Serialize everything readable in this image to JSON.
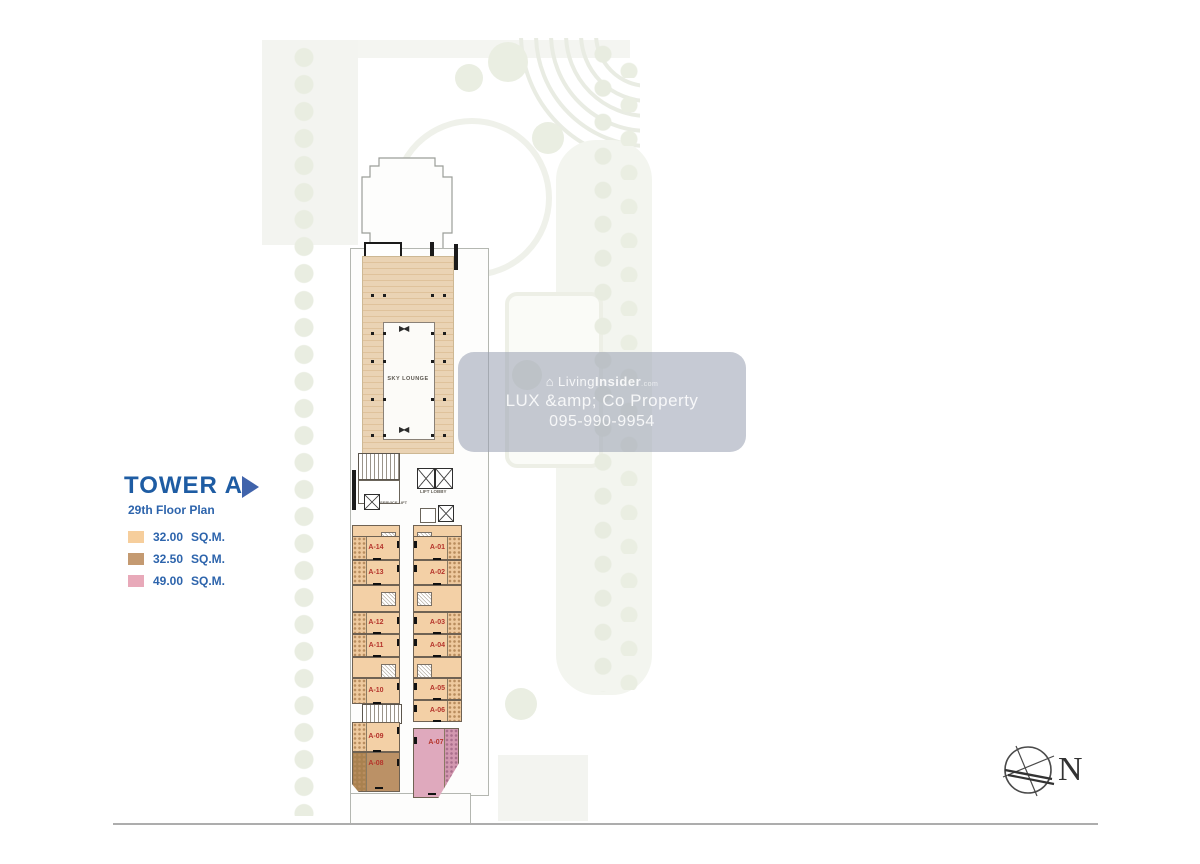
{
  "legend": {
    "title": "TOWER A",
    "subtitle": "29th Floor Plan",
    "entries": [
      {
        "color": "#F6CE9C",
        "area": "32.00",
        "unit": "SQ.M."
      },
      {
        "color": "#C49A71",
        "area": "32.50",
        "unit": "SQ.M."
      },
      {
        "color": "#E8A9B9",
        "area": "49.00",
        "unit": "SQ.M."
      }
    ]
  },
  "plan": {
    "labels": {
      "sky_lounge": "SKY LOUNGE",
      "lift_lobby": "LIFT LOBBY",
      "service_lift": "SERVICE LIFT"
    },
    "units": [
      {
        "label": "A-01",
        "size_sqm": "32.00"
      },
      {
        "label": "A-02",
        "size_sqm": "32.00"
      },
      {
        "label": "A-03",
        "size_sqm": "32.00"
      },
      {
        "label": "A-04",
        "size_sqm": "32.00"
      },
      {
        "label": "A-05",
        "size_sqm": "32.00"
      },
      {
        "label": "A-06",
        "size_sqm": "32.00"
      },
      {
        "label": "A-07",
        "size_sqm": "49.00"
      },
      {
        "label": "A-08",
        "size_sqm": "32.50"
      },
      {
        "label": "A-09",
        "size_sqm": "32.00"
      },
      {
        "label": "A-10",
        "size_sqm": "32.00"
      },
      {
        "label": "A-11",
        "size_sqm": "32.00"
      },
      {
        "label": "A-12",
        "size_sqm": "32.00"
      },
      {
        "label": "A-13",
        "size_sqm": "32.00"
      },
      {
        "label": "A-14",
        "size_sqm": "32.00"
      }
    ],
    "colors": {
      "unit_32": "#F3D0A6",
      "unit_325": "#BB9166",
      "unit_49": "#DFA9BD",
      "unit_label": "#B5342B",
      "deck": "#EAD3B4"
    }
  },
  "watermark": {
    "brand_prefix": "Living",
    "brand_suffix": "Insider",
    "brand_tld": ".com",
    "line2": "LUX &amp; Co Property",
    "line3": "095-990-9954"
  },
  "compass": {
    "label": "N"
  }
}
